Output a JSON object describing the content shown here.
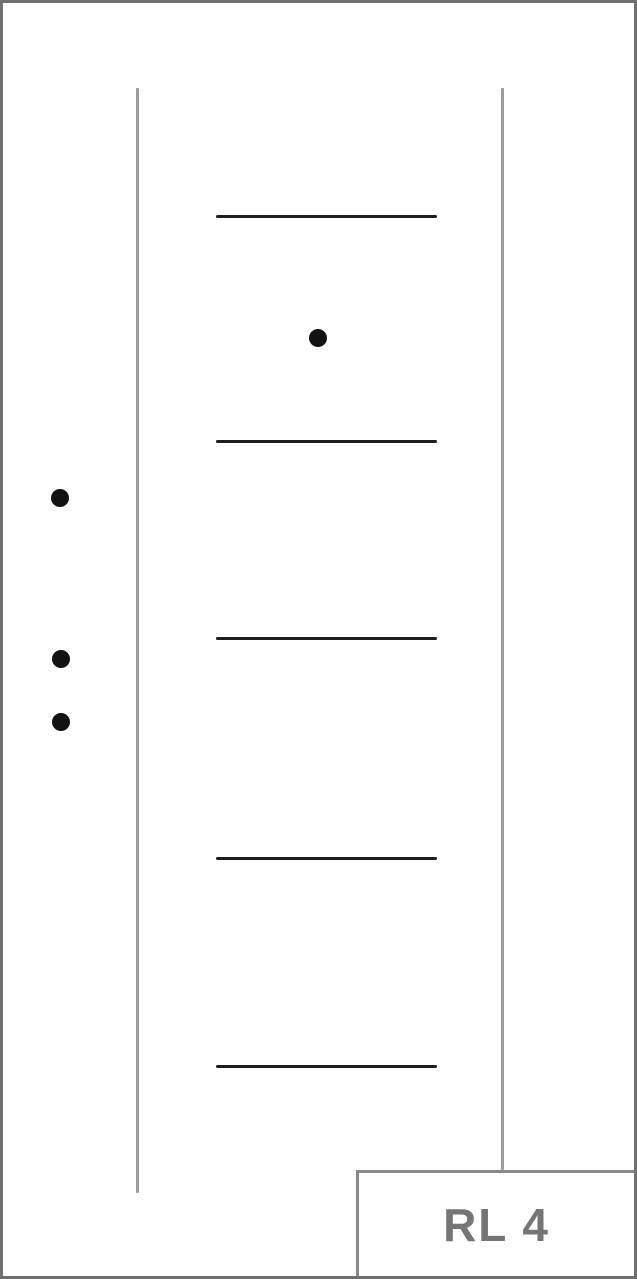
{
  "label": {
    "text": "RL 4"
  },
  "colors": {
    "frame": "#6f6f6f",
    "guide_line": "#9c9c9c",
    "groove_line": "#1e1e1e",
    "dot": "#121212",
    "label_border": "#8a8a8a",
    "label_text": "#757575",
    "background": "#ffffff"
  },
  "diagram": {
    "vertical_lines": [
      {
        "name": "left-guide-line",
        "x": 136,
        "y1": 88,
        "y2": 1193
      },
      {
        "name": "right-guide-line",
        "x": 501,
        "y1": 88,
        "y2": 1170
      }
    ],
    "horizontal_lines": [
      {
        "name": "groove-line-1",
        "x1": 216,
        "x2": 437,
        "y": 215
      },
      {
        "name": "groove-line-2",
        "x1": 216,
        "x2": 437,
        "y": 440
      },
      {
        "name": "groove-line-3",
        "x1": 216,
        "x2": 437,
        "y": 637
      },
      {
        "name": "groove-line-4",
        "x1": 216,
        "x2": 437,
        "y": 857
      },
      {
        "name": "groove-line-5",
        "x1": 216,
        "x2": 437,
        "y": 1065
      }
    ],
    "dots": [
      {
        "name": "dot-1",
        "cx": 318,
        "cy": 338
      },
      {
        "name": "dot-2",
        "cx": 60,
        "cy": 498
      },
      {
        "name": "dot-3",
        "cx": 61,
        "cy": 659
      },
      {
        "name": "dot-4",
        "cx": 61,
        "cy": 722
      }
    ],
    "dot_diameter": 18
  }
}
